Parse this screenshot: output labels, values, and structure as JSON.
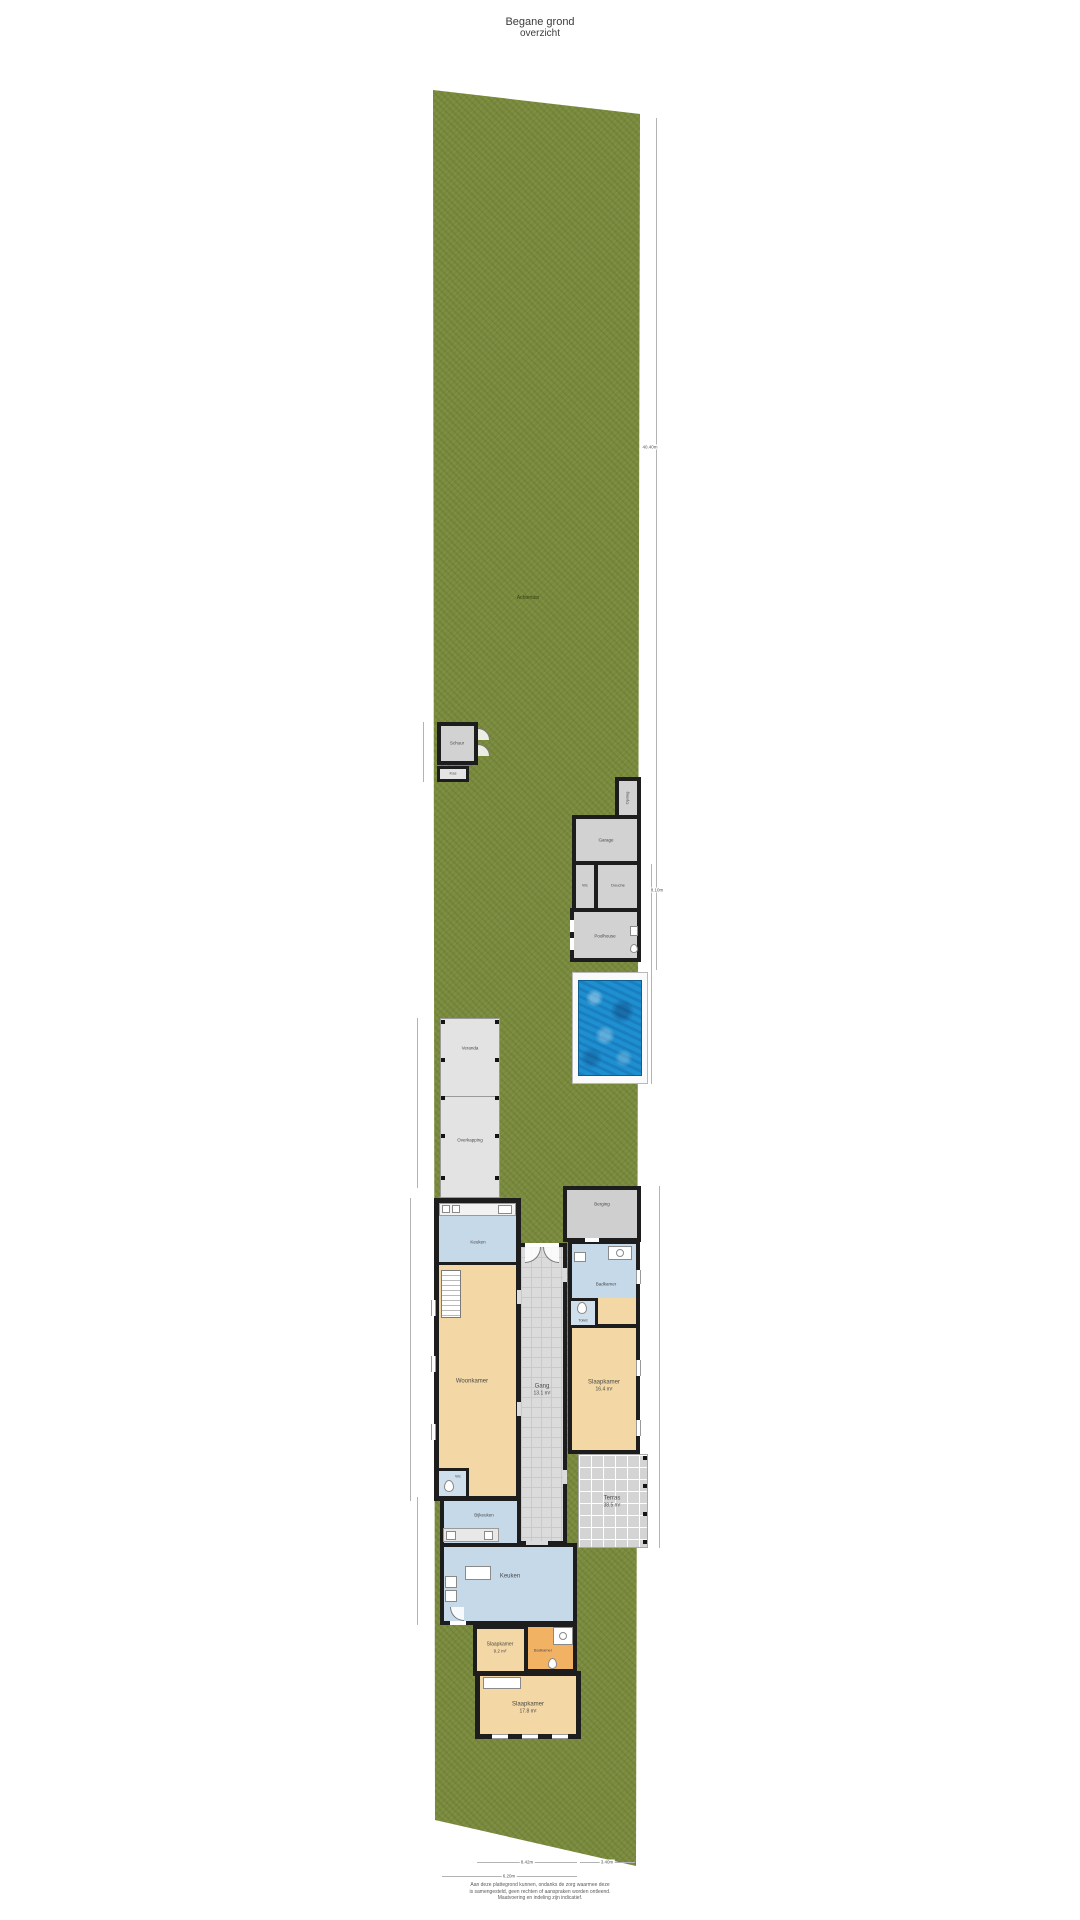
{
  "title": {
    "line1": "Begane grond",
    "line2": "overzicht"
  },
  "garden": {
    "label": "Achtertuin"
  },
  "outbuildings": {
    "shed": "Schuur",
    "greenhouse": "Kas",
    "storage": "Opslag",
    "garage": "Garage",
    "wc": "Wc",
    "shower": "Douche",
    "poolhouse": "Poolhouse"
  },
  "house": {
    "veranda": "Veranda",
    "overkapping": "Overkapping",
    "keuken_achter": "Keuken",
    "woonkamer": "Woonkamer",
    "wc_achter": "Wc",
    "gang": "Gang",
    "gang_area": "13.1 m²",
    "berging": "Berging",
    "badkamer_rechts": "Badkamer",
    "toilet": "Toilet",
    "slaapkamer_rechts": "Slaapkamer",
    "slaapkamer_rechts_area": "16.4 m²",
    "terras": "Terras",
    "terras_area": "38.5 m²",
    "bijkeuken": "Bijkeuken",
    "keuken": "Keuken",
    "slaapkamer_1": "Slaapkamer",
    "slaapkamer_1_area": "9.2 m²",
    "badkamer": "Badkamer",
    "slaapkamer_2": "Slaapkamer",
    "slaapkamer_2_area": "17.8 m²"
  },
  "dimensions": {
    "right_total": "40.40m",
    "right_pool": "8.10m",
    "bottom_house": "8.42m",
    "bottom_terras": "3.40m",
    "bottom_total": "6.20m"
  },
  "footer": {
    "line1": "Aan deze plattegrond kunnen, ondanks de zorg waarmee deze",
    "line2": "is samengesteld, geen rechten of aanspraken worden ontleend.",
    "line3": "Maatvoering en indeling zijn indicatief."
  },
  "colors": {
    "grass": "#7a8b3d",
    "water": "#1e8fd0",
    "wall": "#1d1d1d",
    "room_tan": "#f3d7a4",
    "room_blue": "#c6d9e9",
    "room_orange": "#f2b263",
    "room_gray": "#d2d2d2"
  }
}
